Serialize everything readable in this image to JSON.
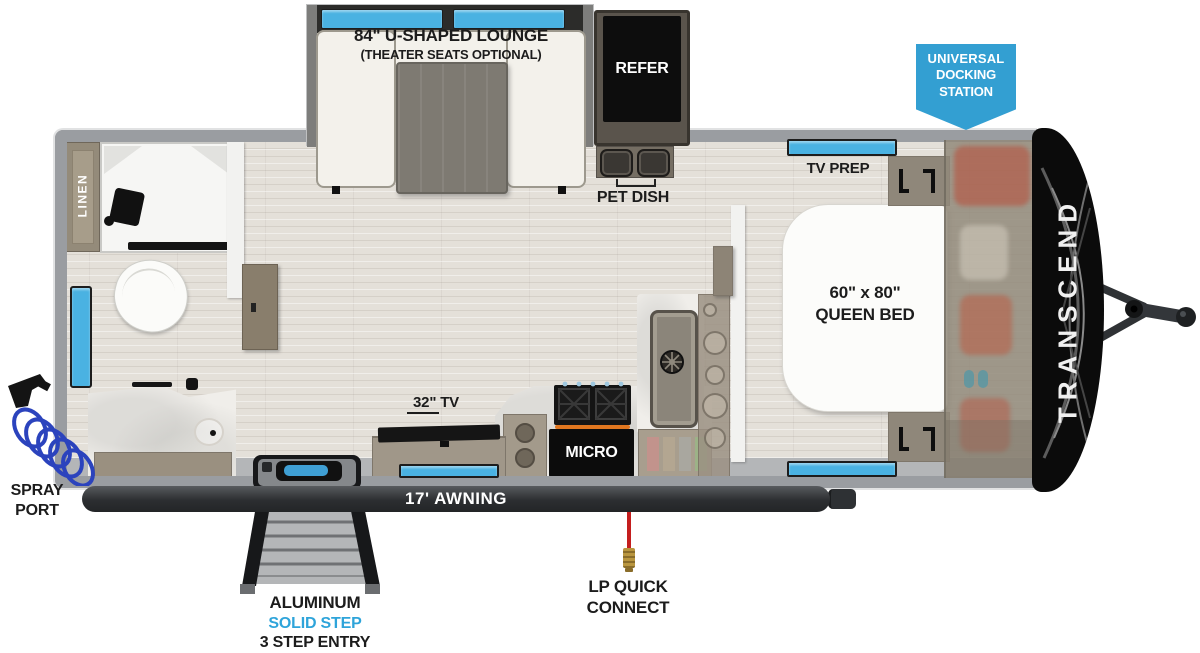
{
  "title": "Transcend travel trailer floorplan",
  "colors": {
    "window_blue": "#4ab2e2",
    "badge_blue": "#339fd2",
    "step_text_blue": "#2ea4da",
    "coil_blue": "#2b43bd",
    "lp_red": "#c41e1e",
    "lp_brass": "#b9963f",
    "awning_dark": "#2c2e31",
    "label_black": "#1c1c1c"
  },
  "lounge": {
    "line1": "84\" U-SHAPED LOUNGE",
    "line2": "(THEATER SEATS OPTIONAL)"
  },
  "kitchen": {
    "refer": "REFER",
    "pet_dish": "PET DISH",
    "micro": "MICRO",
    "tv": "32\" TV"
  },
  "bedroom": {
    "tv_prep": "TV PREP",
    "bed_line1": "60\" x 80\"",
    "bed_line2": "QUEEN BED"
  },
  "bath": {
    "linen": "LINEN"
  },
  "exterior": {
    "docking": [
      "UNIVERSAL",
      "DOCKING",
      "STATION"
    ],
    "awning": "17' AWNING",
    "spray": [
      "SPRAY",
      "PORT"
    ],
    "lp": [
      "LP QUICK",
      "CONNECT"
    ],
    "steps": [
      "ALUMINUM",
      "SOLID STEP",
      "3 STEP ENTRY"
    ],
    "brand": "TRANSCEND"
  }
}
